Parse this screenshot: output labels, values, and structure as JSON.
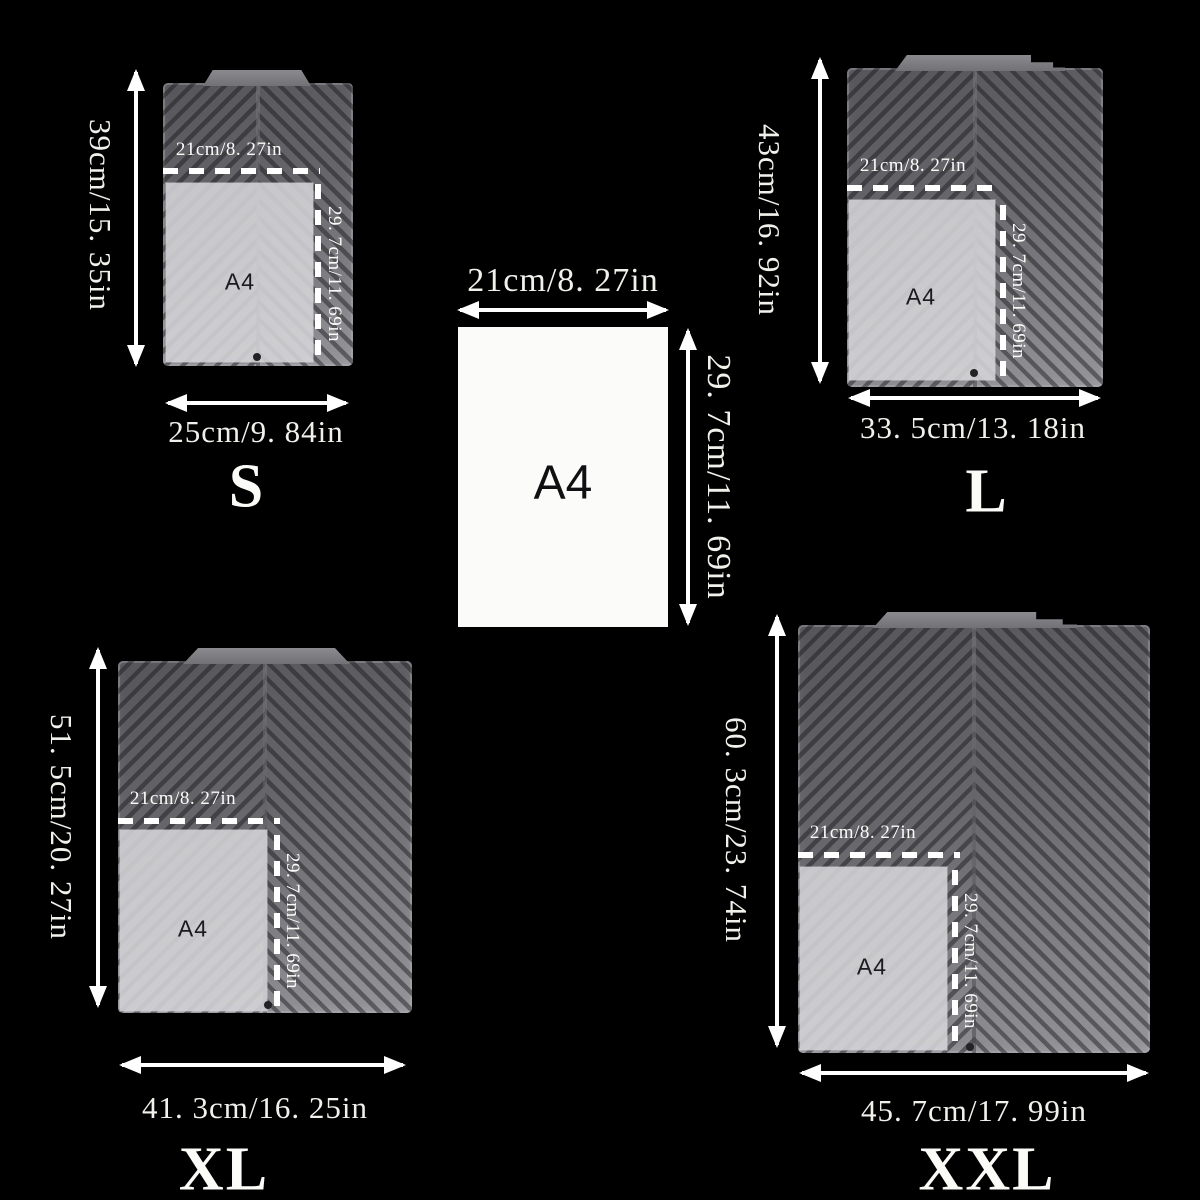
{
  "colors": {
    "background": "#000000",
    "text": "#f1f1ec",
    "mat_dark": "#55555a",
    "mat_light": "#95959a",
    "overlay": "#d7d7da",
    "paper": "#fbfbfa",
    "dark_label": "#1b1b1d"
  },
  "reference": {
    "paper_label": "A4",
    "width_label": "21cm/8. 27in",
    "height_label": "29. 7cm/11. 69in"
  },
  "mats": {
    "s": {
      "size_letter": "S",
      "height_label": "39cm/15. 35in",
      "width_label": "25cm/9. 84in",
      "a4_width_label": "21cm/8. 27in",
      "a4_height_label": "29. 7cm/11. 69in",
      "a4_label": "A4"
    },
    "l": {
      "size_letter": "L",
      "height_label": "43cm/16. 92in",
      "width_label": "33. 5cm/13. 18in",
      "a4_width_label": "21cm/8. 27in",
      "a4_height_label": "29. 7cm/11. 69in",
      "a4_label": "A4"
    },
    "xl": {
      "size_letter": "XL",
      "height_label": "51. 5cm/20. 27in",
      "width_label": "41. 3cm/16. 25in",
      "a4_width_label": "21cm/8. 27in",
      "a4_height_label": "29. 7cm/11. 69in",
      "a4_label": "A4"
    },
    "xxl": {
      "size_letter": "XXL",
      "height_label": "60. 3cm/23. 74in",
      "width_label": "45. 7cm/17. 99in",
      "a4_width_label": "21cm/8. 27in",
      "a4_height_label": "29. 7cm/11. 69in",
      "a4_label": "A4"
    }
  }
}
